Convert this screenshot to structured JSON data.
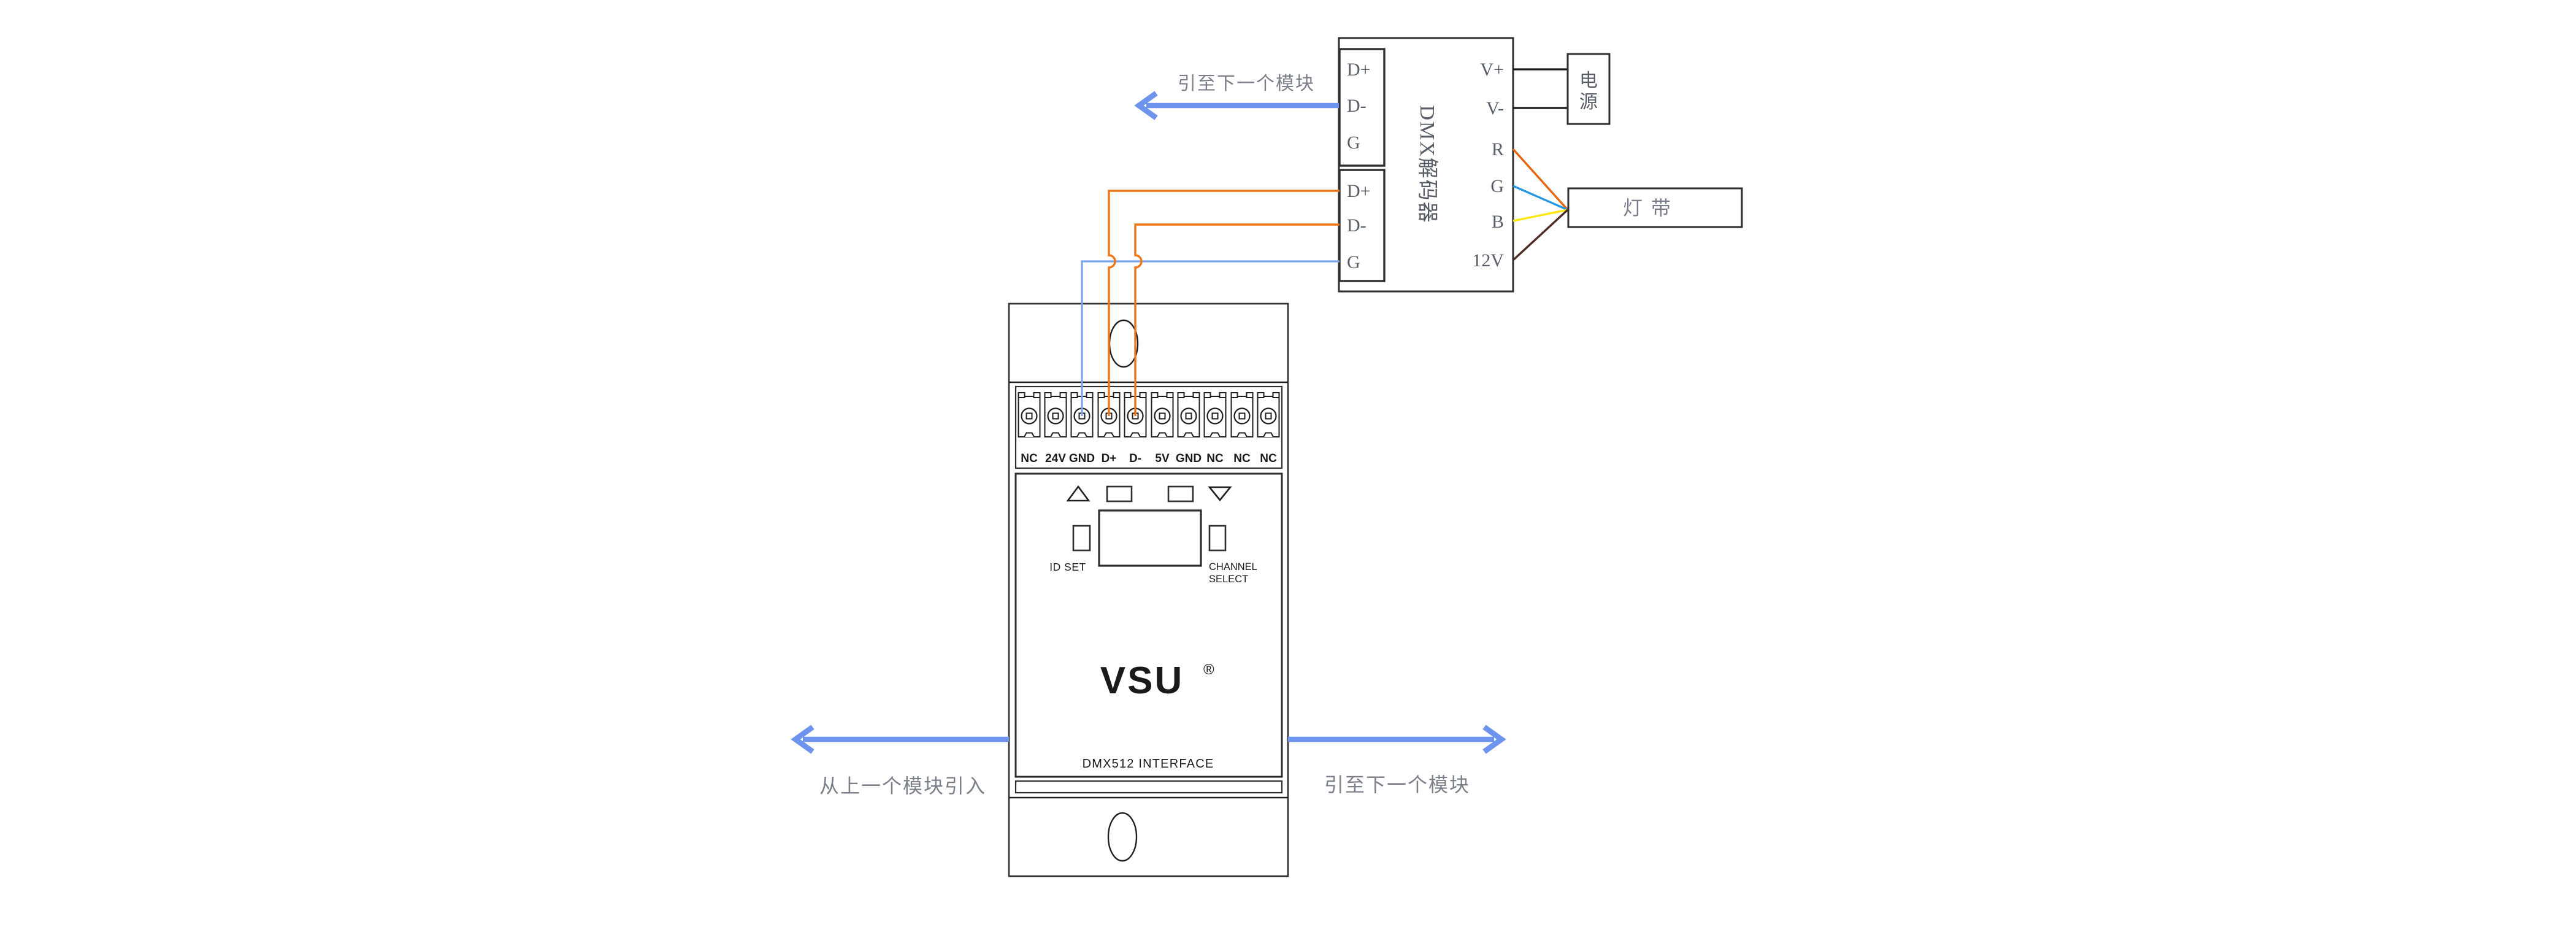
{
  "decoder": {
    "title": "DMX解码器",
    "upper_terminals": {
      "dplus": "D+",
      "dminus": "D-",
      "g": "G"
    },
    "lower_terminals": {
      "dplus": "D+",
      "dminus": "D-",
      "g": "G"
    },
    "right_labels": {
      "vplus": "V+",
      "vminus": "V-",
      "r": "R",
      "g": "G",
      "b": "B",
      "v12": "12V"
    }
  },
  "power_box": {
    "char1": "电",
    "char2": "源"
  },
  "led_strip": {
    "label": "灯带"
  },
  "module": {
    "brand": "VSU",
    "brand_reg": "®",
    "subtitle": "DMX512 INTERFACE",
    "id_set_label": "ID SET",
    "channel_select_line1": "CHANNEL",
    "channel_select_line2": "SELECT",
    "terminals": [
      "NC",
      "24V",
      "GND",
      "D+",
      "D-",
      "5V",
      "GND",
      "NC",
      "NC",
      "NC"
    ]
  },
  "annotations": {
    "top_next": "引至下一个模块",
    "bottom_prev": "从上一个模块引入",
    "bottom_next": "引至下一个模块"
  },
  "colors": {
    "arrow_blue": "#6e93ee",
    "wire_blue": "#7ba3e8",
    "wire_orange": "#f07514",
    "wire_r": "#e8650f",
    "wire_g": "#2196e3",
    "wire_b": "#ffe713",
    "wire_12v": "#4f2a24",
    "power_line": "#1a1a1a",
    "outline": "#2e2e2e"
  }
}
